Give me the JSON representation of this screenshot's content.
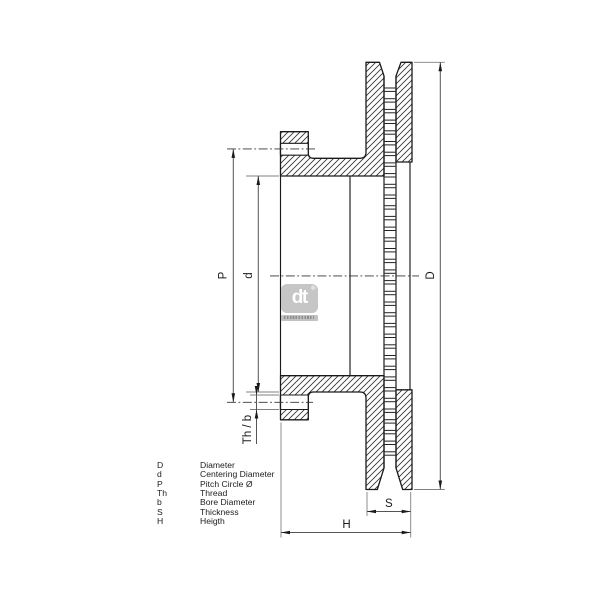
{
  "dimension_labels": {
    "diameter": "D",
    "centering_diameter": "d",
    "pitch_circle": "P",
    "thread_bore": "Th / b",
    "thickness": "S",
    "height": "H"
  },
  "legend": {
    "rows": [
      {
        "symbol": "D",
        "description": "Diameter"
      },
      {
        "symbol": "d",
        "description": "Centering Diameter"
      },
      {
        "symbol": "P",
        "description": "Pitch Circle Ø"
      },
      {
        "symbol": "Th",
        "description": "Thread"
      },
      {
        "symbol": "b",
        "description": "Bore Diameter"
      },
      {
        "symbol": "S",
        "description": "Thickness"
      },
      {
        "symbol": "H",
        "description": "Heigth"
      }
    ]
  },
  "logo": {
    "brand": "dt",
    "registered_mark": "®"
  },
  "colors": {
    "line": "#1a1a1a",
    "dimension_line": "#555555",
    "extension_line": "#808080",
    "centerline": "#333333",
    "logo_gray": "#c6c6c6",
    "background": "#ffffff"
  }
}
